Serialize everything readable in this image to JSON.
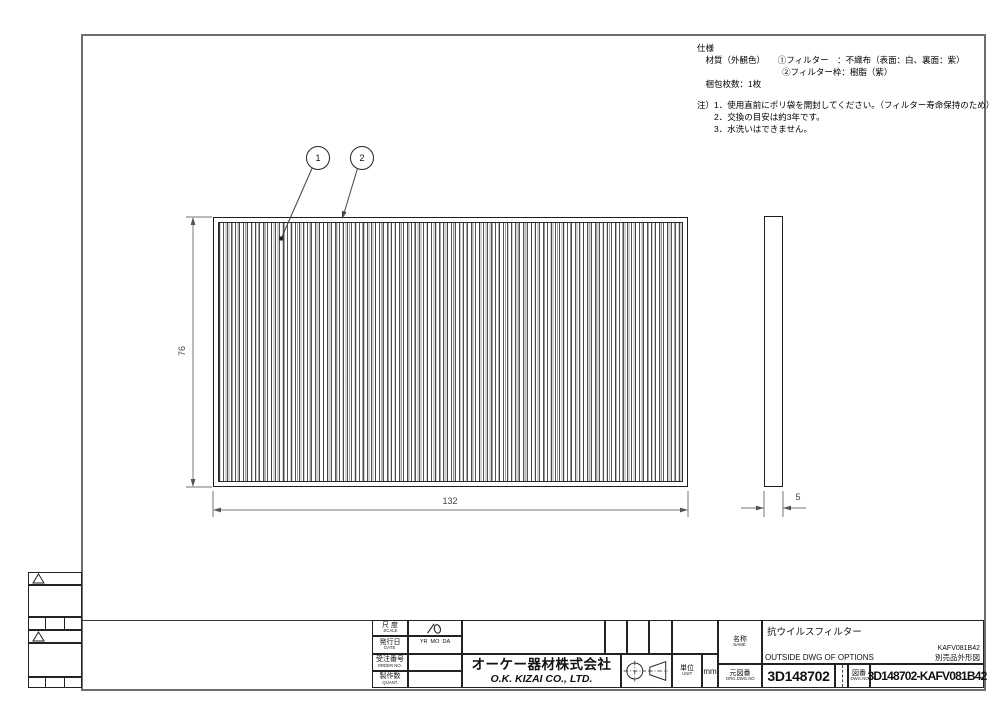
{
  "spec_notes": {
    "line1": "仕様",
    "line2": "　材質（外観色）　　①フィルター　：不織布（表面：白、裏面：紫）",
    "line3": "　　　　　　　　　　②フィルター枠：樹脂（紫）",
    "line4": "　梱包枚数：1枚",
    "note1": "注）1．使用直前にポリ袋を開封してください。（フィルター寿命保持のため）",
    "note2": "　　2．交換の目安は約3年です。",
    "note3": "　　3．水洗いはできません。"
  },
  "drawing": {
    "balloons": [
      {
        "label": "1"
      },
      {
        "label": "2"
      }
    ],
    "dim_width": "132",
    "dim_height": "76",
    "dim_thickness": "5"
  },
  "title_block": {
    "scale_label_jp": "尺 度",
    "scale_label_en": "SCALE",
    "date_label_jp": "発行日",
    "date_label_en": "DATE",
    "date_value": "YR  MO  DA",
    "order_label_jp": "受注番号",
    "order_label_en": "ORDER NO.",
    "qty_label_jp": "製作数",
    "qty_label_en": "QUANT.",
    "company_jp": "オーケー器材株式会社",
    "company_en": "O.K. KIZAI CO., LTD.",
    "unit_label_jp": "単位",
    "unit_label_en": "UNIT",
    "unit_value": "mm",
    "name_label_jp": "名称",
    "name_label_en": "NAME",
    "name_value": "抗ウイルスフィルター",
    "subtitle_en": "OUTSIDE DWG OF OPTIONS",
    "code_right_top": "KAFV081B42",
    "code_right_bottom": "別売品外形図",
    "org_dwg_label_jp": "元図番",
    "org_dwg_label_en": "ORG.DWG.NO",
    "org_dwg_value": "3D148702",
    "dwg_label_jp": "図番",
    "dwg_label_en": "DWG.NO",
    "dwg_value": "3D148702-KAFV081B42"
  },
  "colors": {
    "border": "#6e6e6e",
    "line": "#1e1e1e",
    "dim": "#777777"
  }
}
